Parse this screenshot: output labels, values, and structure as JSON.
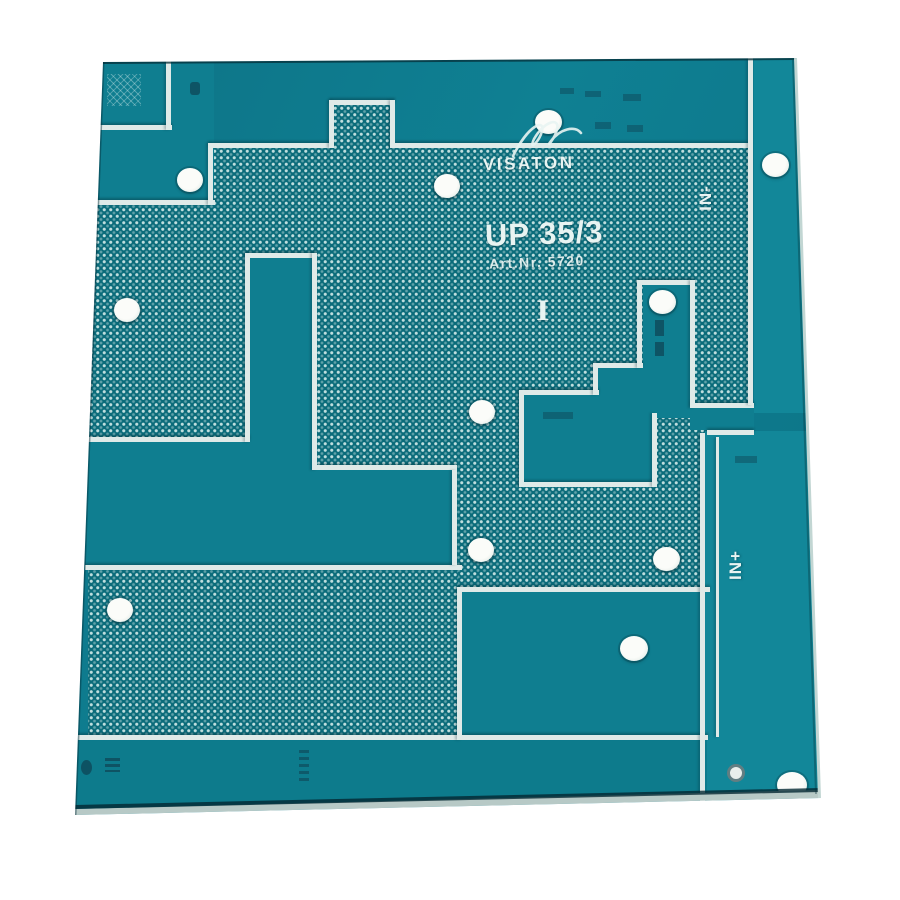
{
  "photo": {
    "description": "Photograph of a teal crossover printed circuit board on a white background",
    "background_color": "#ffffff"
  },
  "board": {
    "brand": "VISATON",
    "model": "UP 35/3",
    "article_number": "Art.Nr. 5720",
    "center_marker": "I",
    "labels": {
      "input_negative": "IN-",
      "input_positive": "IN+"
    },
    "drill_hole_count": 12,
    "colors": {
      "solder_mask_teal": "#0f7e90",
      "copper_pour_teal": "#0a6b7a",
      "pour_dot": "#dff2ef",
      "clearance_line": "#dfeae8",
      "silkscreen_text": "#e8f4f2",
      "drill_hole": "#f7f8f4",
      "board_edge_shadow": "#052d37"
    }
  }
}
